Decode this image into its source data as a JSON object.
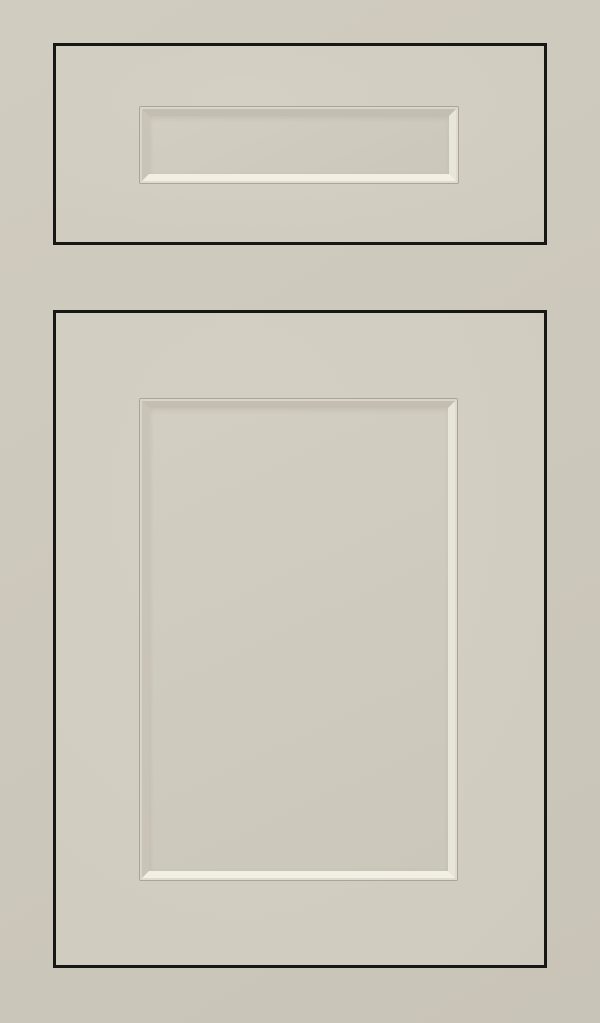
{
  "scene": {
    "description": "Light greige painted inset cabinet sample with a shaker-style drawer front above a matching cabinet door, each with a recessed flat center panel framed by a beveled edge and separated by thin black reveal gaps",
    "drawer_label": "drawer-front-with-recessed-panel",
    "door_label": "door-front-with-recessed-panel"
  },
  "colors": {
    "bg-frame-light": "#d1ccc0",
    "bg-frame-dark": "#c9c4b8",
    "face-light": "#d4d0c4",
    "face-mid": "#d0ccc0",
    "face-dark": "#cac6b9",
    "reveal-outline": "#171716",
    "groove-line": "#aaa597",
    "lip-light": "#d9d5c9",
    "lip-lighter": "#dfdbcf",
    "slope-shadow-top": "#c3beb1",
    "slope-shadow-left": "#c9c4b7",
    "slope-highlight-right": "#e8e5d9",
    "slope-highlight-bottom": "#f2f0e5",
    "field-light": "#d2cec2",
    "field-dark": "#cbc7ba"
  }
}
